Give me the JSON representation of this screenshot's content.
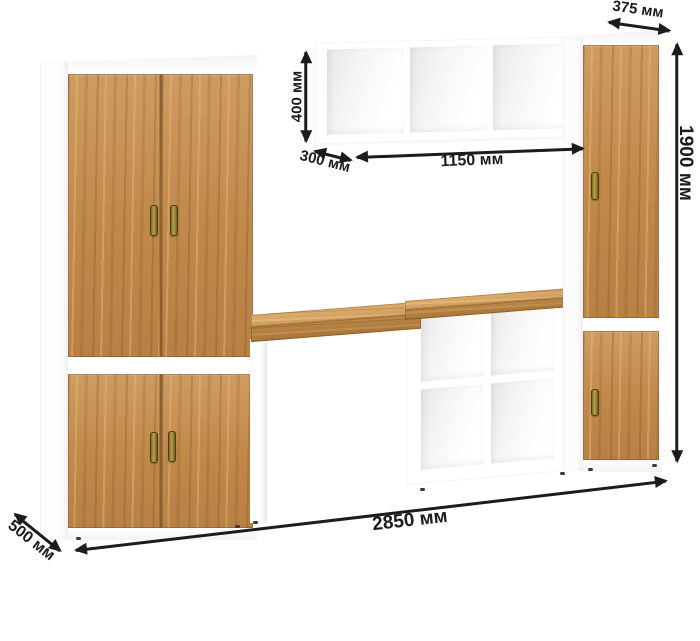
{
  "annotations": {
    "top_depth": {
      "label": "375 мм"
    },
    "shelf_height": {
      "label": "400 мм"
    },
    "shelf_depth": {
      "label": "300 мм"
    },
    "shelf_width": {
      "label": "1150 мм"
    },
    "total_height": {
      "label": "1900 мм"
    },
    "total_width": {
      "label": "2850 мм"
    },
    "base_depth": {
      "label": "500 мм"
    }
  },
  "colors": {
    "wood": "#c28a4e",
    "wood_light": "#d8ab72",
    "wood_dark": "#9c6b38",
    "carcass": "#ffffff",
    "dimension_ink": "#1c1c1c",
    "handle_brass": "#8f7a2c"
  }
}
